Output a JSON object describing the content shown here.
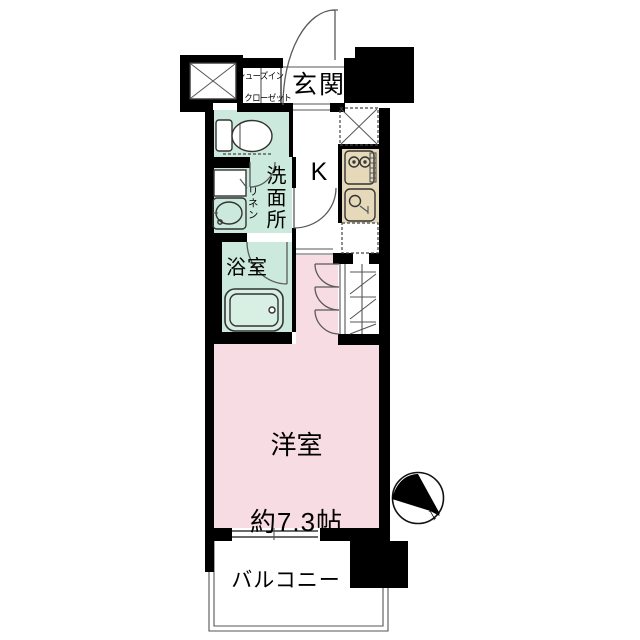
{
  "floorplan": {
    "rooms": {
      "entrance": "玄関",
      "shoe_closet_line1": "シューズイン",
      "shoe_closet_line2": "クローゼット",
      "kitchen": "K",
      "washroom": "洗面所",
      "linen": "リネン",
      "bathroom": "浴室",
      "western_room": "洋室",
      "western_room_size": "約7.3帖",
      "balcony": "バルコニー"
    },
    "compass": {
      "north": "N"
    },
    "colors": {
      "wall": "#000000",
      "wet_area_green": "#cbe9dc",
      "bathtub_green": "#d8efe3",
      "room_pink": "#f8dce4",
      "kitchen_beige": "#e6d9ba",
      "background": "#ffffff",
      "line": "#3a3a3a"
    }
  }
}
